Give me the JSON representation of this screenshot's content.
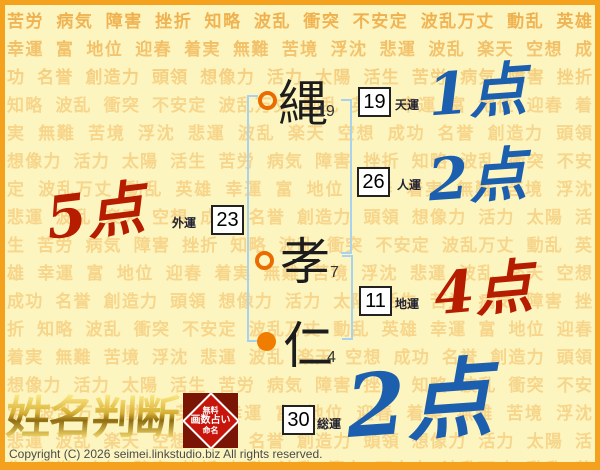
{
  "background": {
    "words": [
      "苦労",
      "病気",
      "障害",
      "挫折",
      "知略",
      "波乱",
      "衝突",
      "不安定",
      "波乱万丈",
      "動乱",
      "英雄",
      "幸運",
      "富",
      "地位",
      "迎春",
      "着実",
      "無難",
      "苦境",
      "浮沈",
      "悲運",
      "波乱",
      "楽天",
      "空想",
      "成功",
      "名誉",
      "創造力",
      "頭領",
      "想像力",
      "活力",
      "太陽",
      "活生"
    ],
    "repeat": 8
  },
  "name": {
    "characters": [
      {
        "char": "縄",
        "strokes": "19",
        "marker": "hollow"
      },
      {
        "char": "孝",
        "strokes": "7",
        "marker": "hollow"
      },
      {
        "char": "仁",
        "strokes": "4",
        "marker": "filled"
      }
    ]
  },
  "fortunes": {
    "tenun": {
      "label": "天運",
      "value": "19",
      "score": "1点"
    },
    "jinun": {
      "label": "人運",
      "value": "26",
      "score": "2点"
    },
    "chiun": {
      "label": "地運",
      "value": "11",
      "score": "4点"
    },
    "gaiun": {
      "label": "外運",
      "value": "23",
      "score": "5点"
    },
    "souun": {
      "label": "総運",
      "value": "30",
      "score": "2点"
    }
  },
  "logo": {
    "title": "姓名判断",
    "badge_lines": [
      "無料",
      "画数占い",
      "命名"
    ]
  },
  "footer": {
    "copyright": "Copyright (C) 2026 seimei.linkstudio.biz All rights reserved."
  },
  "colors": {
    "frame": "#f4a11d",
    "page_bg": "#fdf5bf",
    "background_word": "#eda63e",
    "score_blue": "#1b5fae",
    "score_red": "#b51c00",
    "bracket_blue": "#a8d2ee",
    "marker_orange": "#ee7c00",
    "badge_red": "#c8150c"
  }
}
